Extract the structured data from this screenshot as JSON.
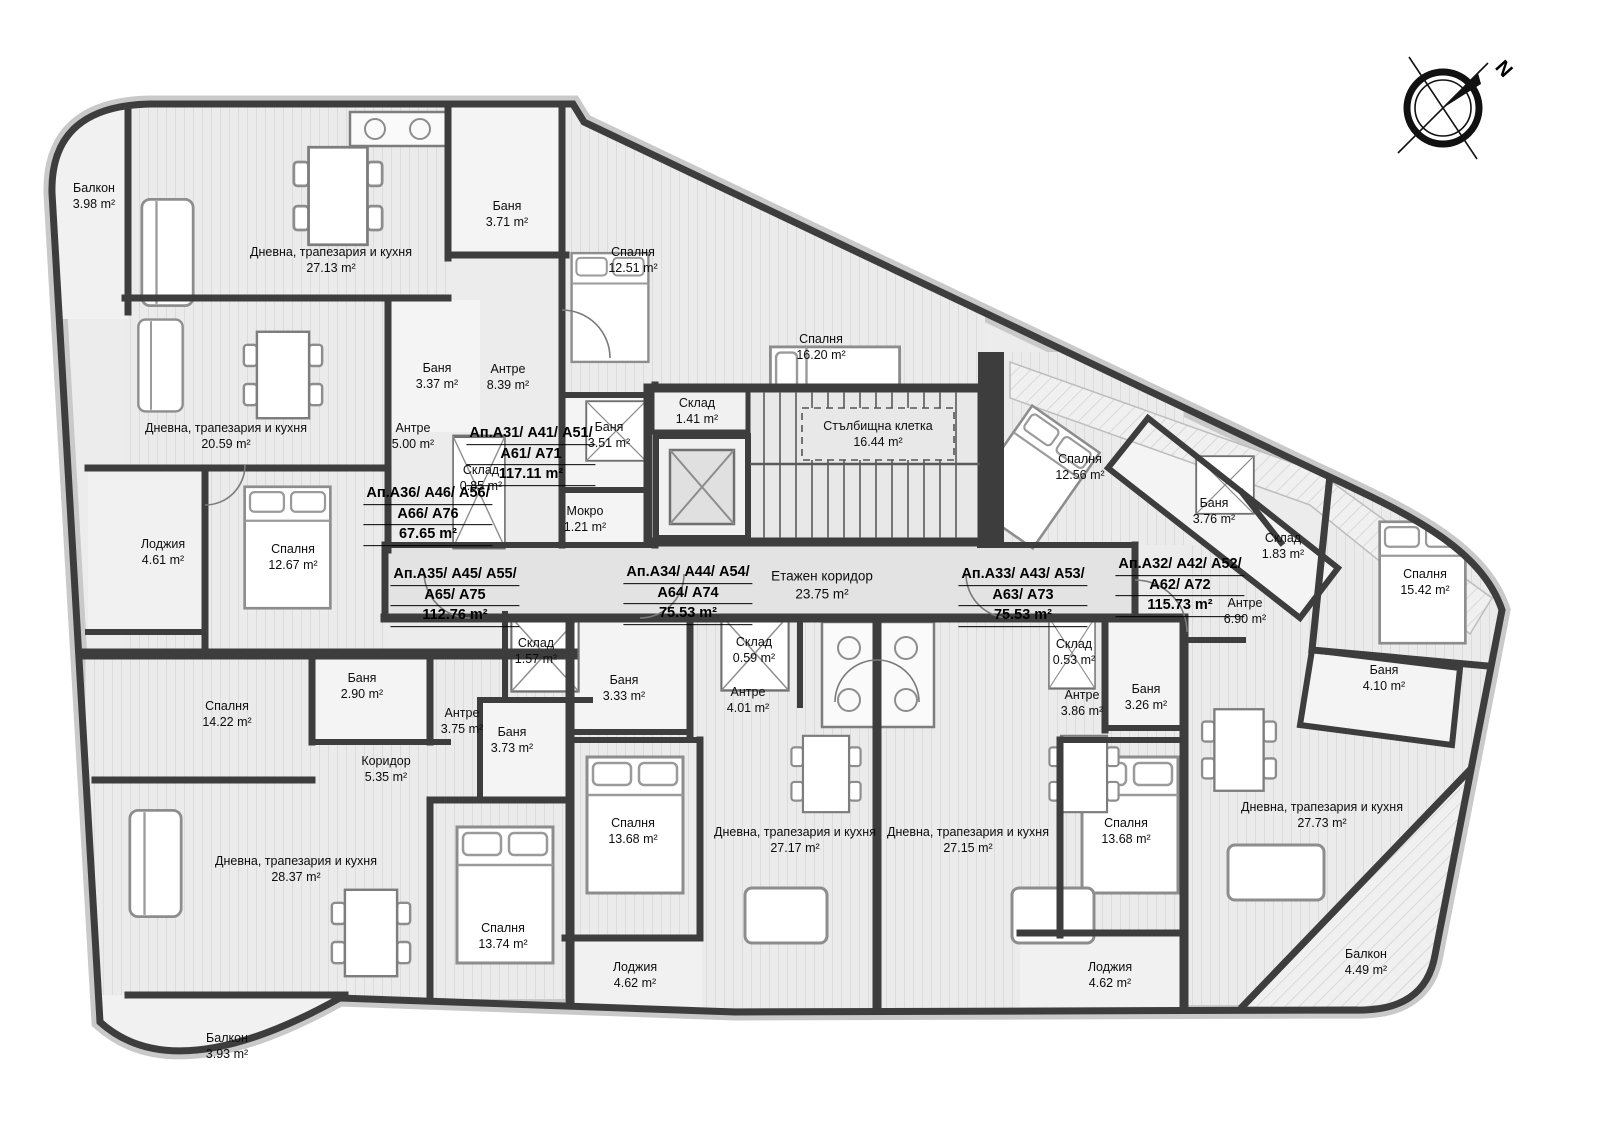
{
  "meta": {
    "compass_label": "N",
    "area_unit": "m²"
  },
  "colors": {
    "wall": "#3d3d3d",
    "facade_trim": "#c9c9c9",
    "floor_base": "#ececec",
    "bath_floor": "#f4f4f4",
    "corridor_floor": "#e3e3e3",
    "text": "#0d0d0d"
  },
  "apartments": [
    {
      "lines": [
        "Ап.А31/ А41/ А51/",
        "А61/ А71",
        "117.11 m²"
      ],
      "x": 531,
      "y": 455
    },
    {
      "lines": [
        "Ап.А36/ А46/ А56/",
        "А66/ А76",
        "67.65 m²"
      ],
      "x": 428,
      "y": 515
    },
    {
      "lines": [
        "Ап.А35/ А45/ А55/",
        "А65/ А75",
        "112.76 m²"
      ],
      "x": 455,
      "y": 596
    },
    {
      "lines": [
        "Ап.А34/ А44/ А54/",
        "А64/ А74",
        "75.53 m²"
      ],
      "x": 688,
      "y": 594
    },
    {
      "lines": [
        "Ап.А33/ А43/ А53/",
        "А63/ А73",
        "75.53 m²"
      ],
      "x": 1023,
      "y": 596
    },
    {
      "lines": [
        "Ап.А32/ А42/ А52/",
        "А62/ А72",
        "115.73 m²"
      ],
      "x": 1180,
      "y": 586
    }
  ],
  "rooms": [
    {
      "name": "Балкон",
      "area": "3.98 m²",
      "x": 94,
      "y": 196
    },
    {
      "name": "Дневна, трапезария и кухня",
      "area": "27.13 m²",
      "x": 331,
      "y": 260
    },
    {
      "name": "Баня",
      "area": "3.71 m²",
      "x": 507,
      "y": 214
    },
    {
      "name": "Спалня",
      "area": "12.51 m²",
      "x": 633,
      "y": 260
    },
    {
      "name": "Спалня",
      "area": "16.20 m²",
      "x": 821,
      "y": 347
    },
    {
      "name": "Антре",
      "area": "8.39 m²",
      "x": 508,
      "y": 377
    },
    {
      "name": "Баня",
      "area": "3.51 m²",
      "x": 609,
      "y": 435
    },
    {
      "name": "Мокро",
      "area": "1.21 m²",
      "x": 585,
      "y": 519
    },
    {
      "name": "Склад",
      "area": "1.41 m²",
      "x": 697,
      "y": 411
    },
    {
      "name": "Дневна, трапезария и кухня",
      "area": "20.59 m²",
      "x": 226,
      "y": 436
    },
    {
      "name": "Баня",
      "area": "3.37 m²",
      "x": 437,
      "y": 376
    },
    {
      "name": "Антре",
      "area": "5.00 m²",
      "x": 413,
      "y": 436
    },
    {
      "name": "Склад",
      "area": "0.85 m²",
      "x": 481,
      "y": 478
    },
    {
      "name": "Спалня",
      "area": "12.67 m²",
      "x": 293,
      "y": 557
    },
    {
      "name": "Лоджия",
      "area": "4.61 m²",
      "x": 163,
      "y": 552
    },
    {
      "name": "Спалня",
      "area": "14.22 m²",
      "x": 227,
      "y": 714
    },
    {
      "name": "Баня",
      "area": "2.90 m²",
      "x": 362,
      "y": 686
    },
    {
      "name": "Антре",
      "area": "3.75 m²",
      "x": 462,
      "y": 721
    },
    {
      "name": "Склад",
      "area": "1.57 m²",
      "x": 536,
      "y": 651
    },
    {
      "name": "Баня",
      "area": "3.73 m²",
      "x": 512,
      "y": 740
    },
    {
      "name": "Коридор",
      "area": "5.35 m²",
      "x": 386,
      "y": 769
    },
    {
      "name": "Дневна, трапезария и кухня",
      "area": "28.37 m²",
      "x": 296,
      "y": 869
    },
    {
      "name": "Спалня",
      "area": "13.74 m²",
      "x": 503,
      "y": 936
    },
    {
      "name": "Балкон",
      "area": "3.93 m²",
      "x": 227,
      "y": 1046
    },
    {
      "name": "Баня",
      "area": "3.33 m²",
      "x": 624,
      "y": 688
    },
    {
      "name": "Склад",
      "area": "0.59 m²",
      "x": 754,
      "y": 650
    },
    {
      "name": "Антре",
      "area": "4.01 m²",
      "x": 748,
      "y": 700
    },
    {
      "name": "Спалня",
      "area": "13.68 m²",
      "x": 633,
      "y": 831
    },
    {
      "name": "Дневна, трапезария и кухня",
      "area": "27.17 m²",
      "x": 795,
      "y": 840
    },
    {
      "name": "Лоджия",
      "area": "4.62 m²",
      "x": 635,
      "y": 975
    },
    {
      "name": "Дневна, трапезария и кухня",
      "area": "27.15 m²",
      "x": 968,
      "y": 840
    },
    {
      "name": "Спалня",
      "area": "13.68 m²",
      "x": 1126,
      "y": 831
    },
    {
      "name": "Антре",
      "area": "3.86 m²",
      "x": 1082,
      "y": 703
    },
    {
      "name": "Баня",
      "area": "3.26 m²",
      "x": 1146,
      "y": 697
    },
    {
      "name": "Склад",
      "area": "0.53 m²",
      "x": 1074,
      "y": 652
    },
    {
      "name": "Лоджия",
      "area": "4.62 m²",
      "x": 1110,
      "y": 975
    },
    {
      "name": "Спалня",
      "area": "12.56 m²",
      "x": 1080,
      "y": 467
    },
    {
      "name": "Баня",
      "area": "3.76 m²",
      "x": 1214,
      "y": 511
    },
    {
      "name": "Склад",
      "area": "1.83 m²",
      "x": 1283,
      "y": 546
    },
    {
      "name": "Антре",
      "area": "6.90 m²",
      "x": 1245,
      "y": 611
    },
    {
      "name": "Спалня",
      "area": "15.42 m²",
      "x": 1425,
      "y": 582
    },
    {
      "name": "Баня",
      "area": "4.10 m²",
      "x": 1384,
      "y": 678
    },
    {
      "name": "Дневна, трапезария и кухня",
      "area": "27.73 m²",
      "x": 1322,
      "y": 815
    },
    {
      "name": "Балкон",
      "area": "4.49 m²",
      "x": 1366,
      "y": 962
    }
  ],
  "common": [
    {
      "name": "Етажен коридор",
      "area": "23.75 m²",
      "x": 822,
      "y": 585,
      "kind": "corridor"
    },
    {
      "name": "Стълбищна клетка",
      "area": "16.44 m²",
      "x": 878,
      "y": 434,
      "kind": "stair"
    }
  ]
}
